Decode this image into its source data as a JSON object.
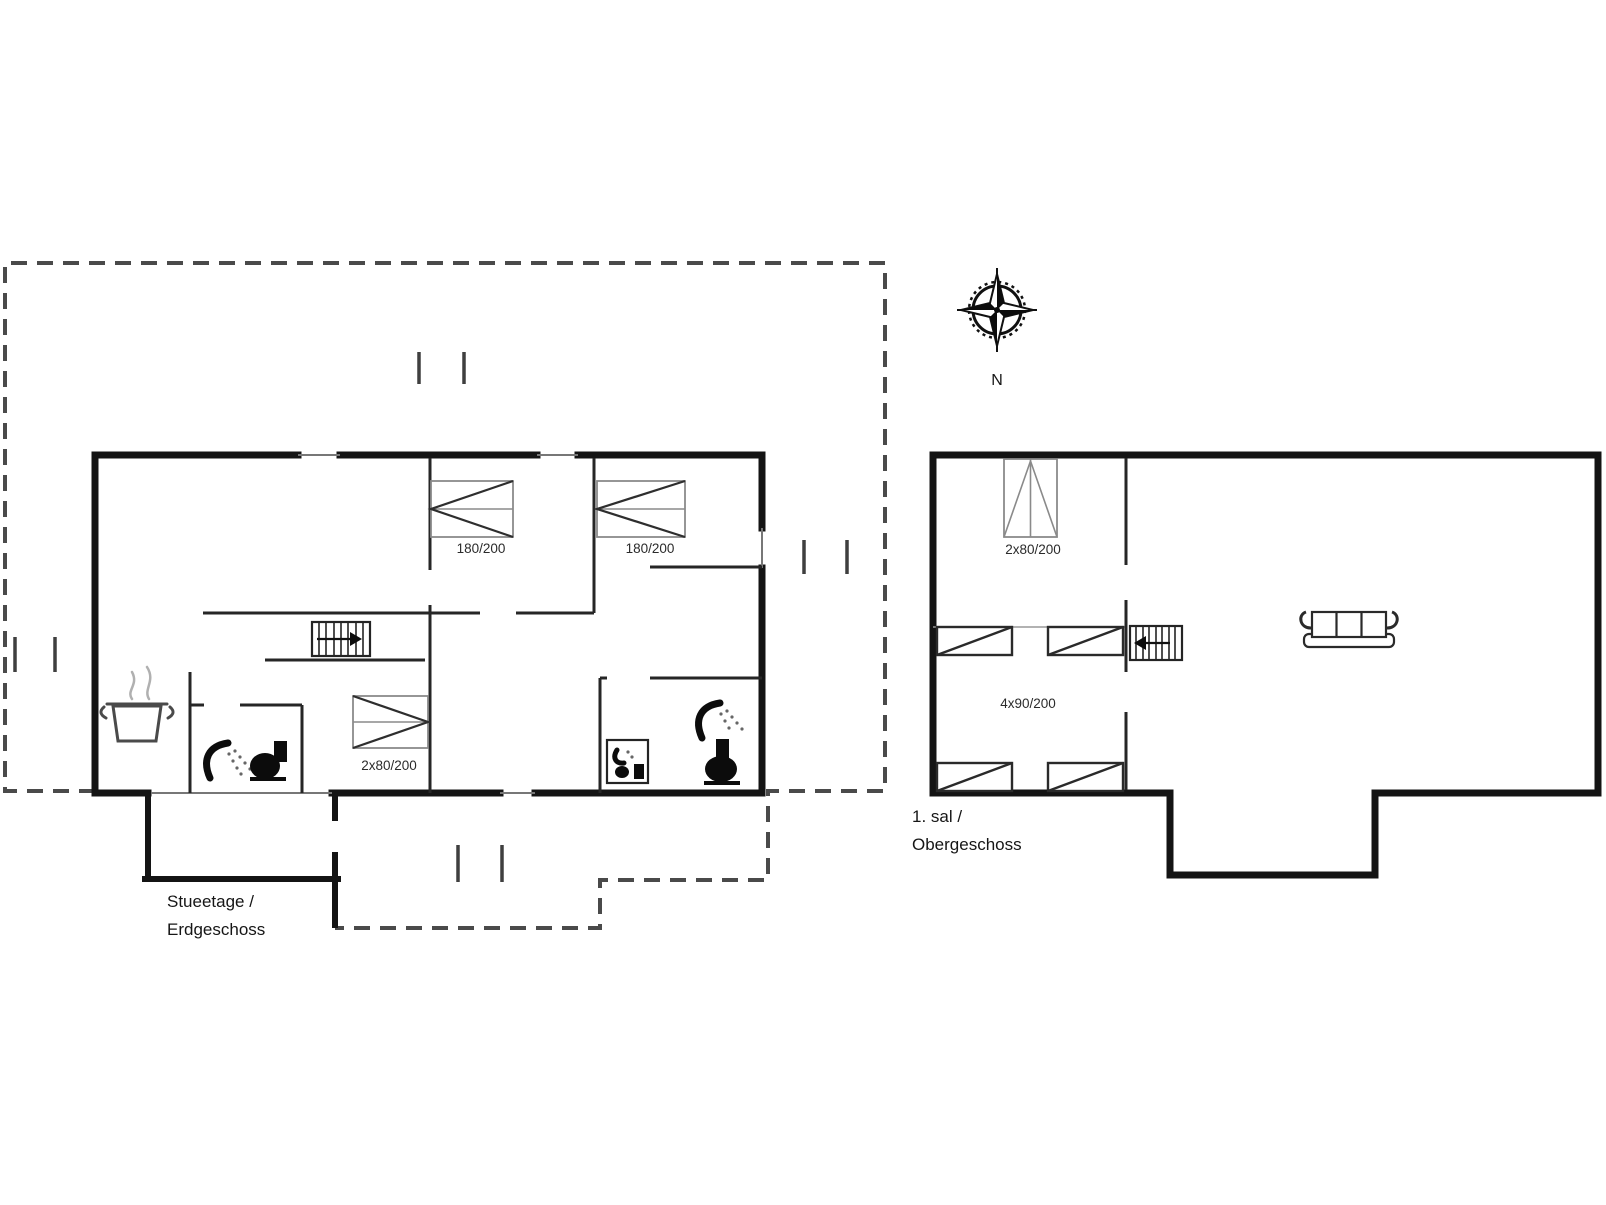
{
  "colors": {
    "background": "#ffffff",
    "exterior_wall": "#141414",
    "interior_wall": "#262626",
    "terrace_dash": "#4a4a4a",
    "bed_outline": "#8a8a8a",
    "label_text": "#161616"
  },
  "compass": {
    "north_label": "N",
    "icon": "compass-rose-icon"
  },
  "ground_floor": {
    "label_line1": "Stueetage /",
    "label_line2": "Erdgeschoss",
    "bed1_label": "180/200",
    "bed2_label": "180/200",
    "bunk_label": "2x80/200",
    "icons": [
      "cooking-pot-icon",
      "shower-icon",
      "toilet-icon",
      "stairs-icon",
      "washbasin-icon",
      "shower-icon",
      "toilet-icon"
    ]
  },
  "first_floor": {
    "label_line1": "1. sal /",
    "label_line2": "Obergeschoss",
    "double_bed_label": "2x80/200",
    "single_beds_label": "4x90/200",
    "icons": [
      "stairs-icon",
      "sofa-icon"
    ]
  }
}
